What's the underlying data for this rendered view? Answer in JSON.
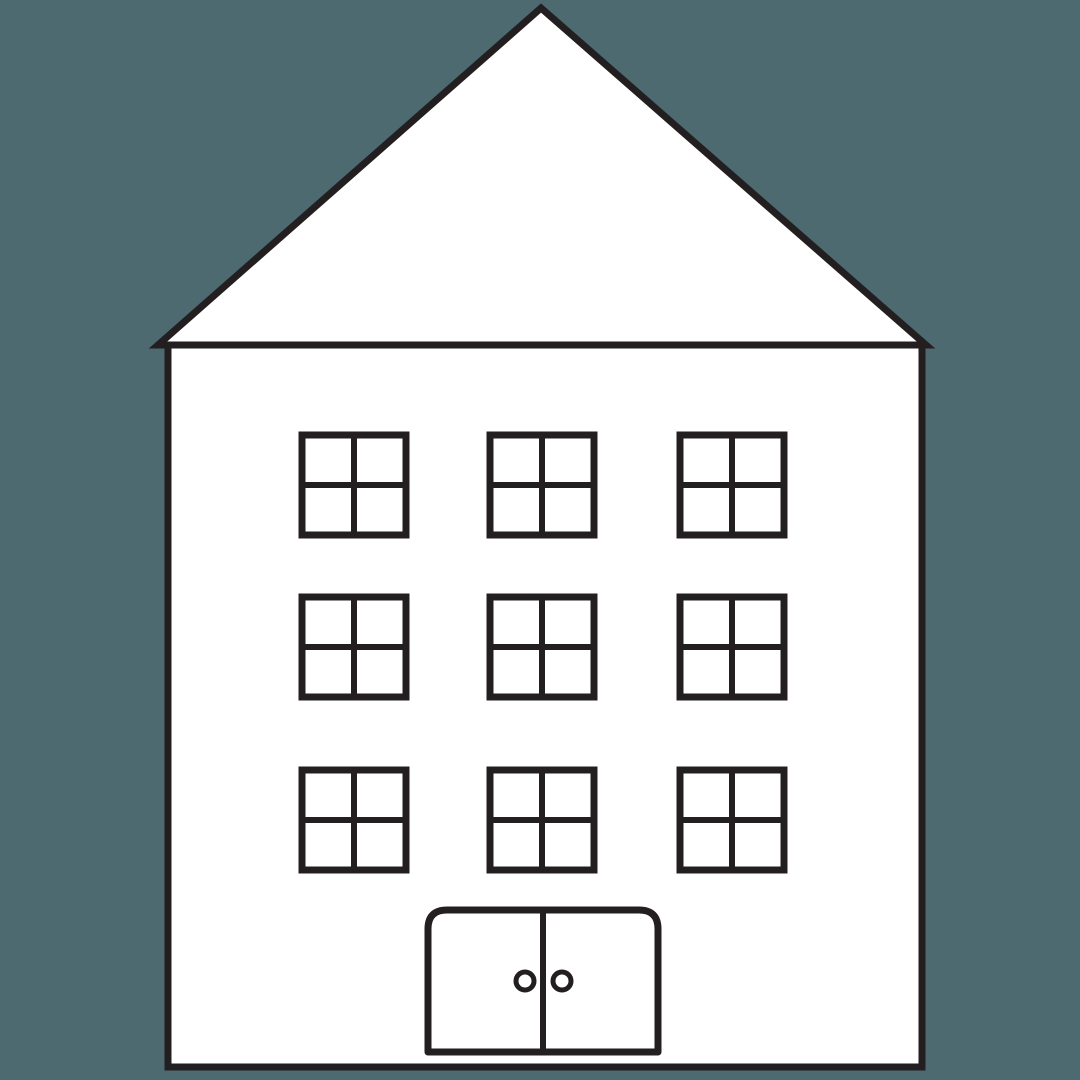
{
  "scene": {
    "background_color": "#4E6A71",
    "line_color": "#231F20",
    "fill_color": "#FFFFFF"
  },
  "house": {
    "roof": {
      "apex": [
        541,
        8
      ],
      "base_left": [
        158,
        345
      ],
      "base_right": [
        926,
        345
      ],
      "stroke_width": 7
    },
    "body": {
      "x": 168,
      "y": 345,
      "width": 754,
      "height": 722,
      "stroke_width": 7
    },
    "windows": {
      "col_x": [
        302,
        490,
        680
      ],
      "row_y": [
        435,
        597,
        770
      ],
      "width": 104,
      "height": 100,
      "frame_stroke_width": 7,
      "mullion_stroke_width": 6,
      "count": 9,
      "panes_per_window": 4
    },
    "door": {
      "x": 428,
      "y": 910,
      "width": 230,
      "height": 142,
      "corner_radius": 19,
      "stroke_width": 7,
      "divider_x": 543,
      "divider_stroke_width": 6,
      "knobs": [
        {
          "cx": 525,
          "cy": 981,
          "r": 9
        },
        {
          "cx": 562,
          "cy": 981,
          "r": 9
        }
      ],
      "knob_stroke_width": 5
    }
  }
}
